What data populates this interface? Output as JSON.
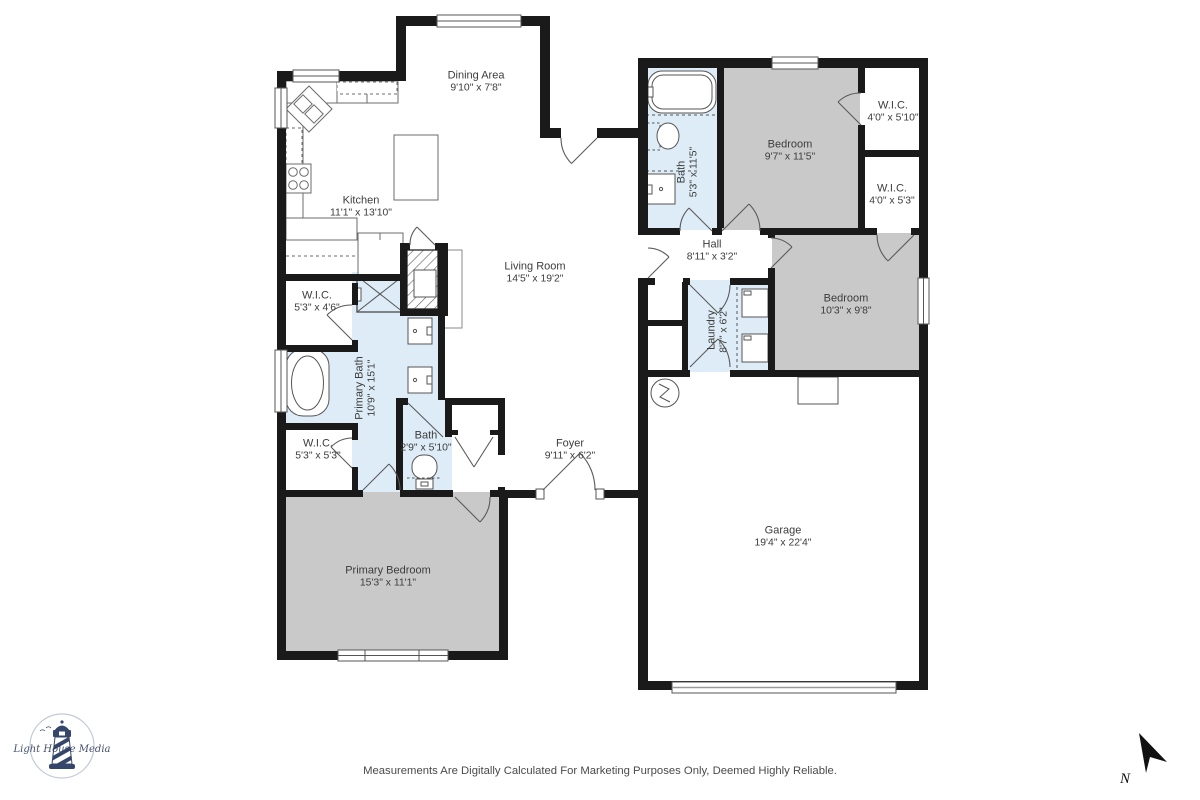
{
  "plan": {
    "footer_disclaimer": "Measurements Are Digitally Calculated For Marketing Purposes Only, Deemed Highly Reliable.",
    "compass_label": "N",
    "logo_text": "Light House Media"
  },
  "colors": {
    "wall": "#1a1a1a",
    "bedroom_fill": "#c9c9c9",
    "wet_room_fill": "#ddecf7",
    "fixture_line": "#555555",
    "label_text": "#3c3c3c",
    "logo_navy": "#36456a"
  },
  "rooms": {
    "dining": {
      "name": "Dining Area",
      "dims": "9'10\" x 7'8\""
    },
    "kitchen": {
      "name": "Kitchen",
      "dims": "11'1\" x 13'10\""
    },
    "living": {
      "name": "Living Room",
      "dims": "14'5\" x 19'2\""
    },
    "bath1": {
      "name": "Bath",
      "dims": "5'3\" x 11'5\""
    },
    "bedroom1": {
      "name": "Bedroom",
      "dims": "9'7\" x 11'5\""
    },
    "wic1": {
      "name": "W.I.C.",
      "dims": "4'0\" x 5'10\""
    },
    "wic2": {
      "name": "W.I.C.",
      "dims": "4'0\" x 5'3\""
    },
    "hall": {
      "name": "Hall",
      "dims": "8'11\" x 3'2\""
    },
    "bedroom2": {
      "name": "Bedroom",
      "dims": "10'3\" x 9'8\""
    },
    "laundry": {
      "name": "Laundry",
      "dims": "8'7\" x 6'2\""
    },
    "wic3": {
      "name": "W.I.C.",
      "dims": "5'3\" x 4'6\""
    },
    "primary_bath": {
      "name": "Primary Bath",
      "dims": "10'9\" x 15'1\""
    },
    "wic4": {
      "name": "W.I.C.",
      "dims": "5'3\" x 5'3\""
    },
    "bath2": {
      "name": "Bath",
      "dims": "2'9\" x 5'10\""
    },
    "foyer": {
      "name": "Foyer",
      "dims": "9'11\" x 6'2\""
    },
    "primary_bedroom": {
      "name": "Primary Bedroom",
      "dims": "15'3\" x 11'1\""
    },
    "garage": {
      "name": "Garage",
      "dims": "19'4\" x 22'4\""
    }
  }
}
